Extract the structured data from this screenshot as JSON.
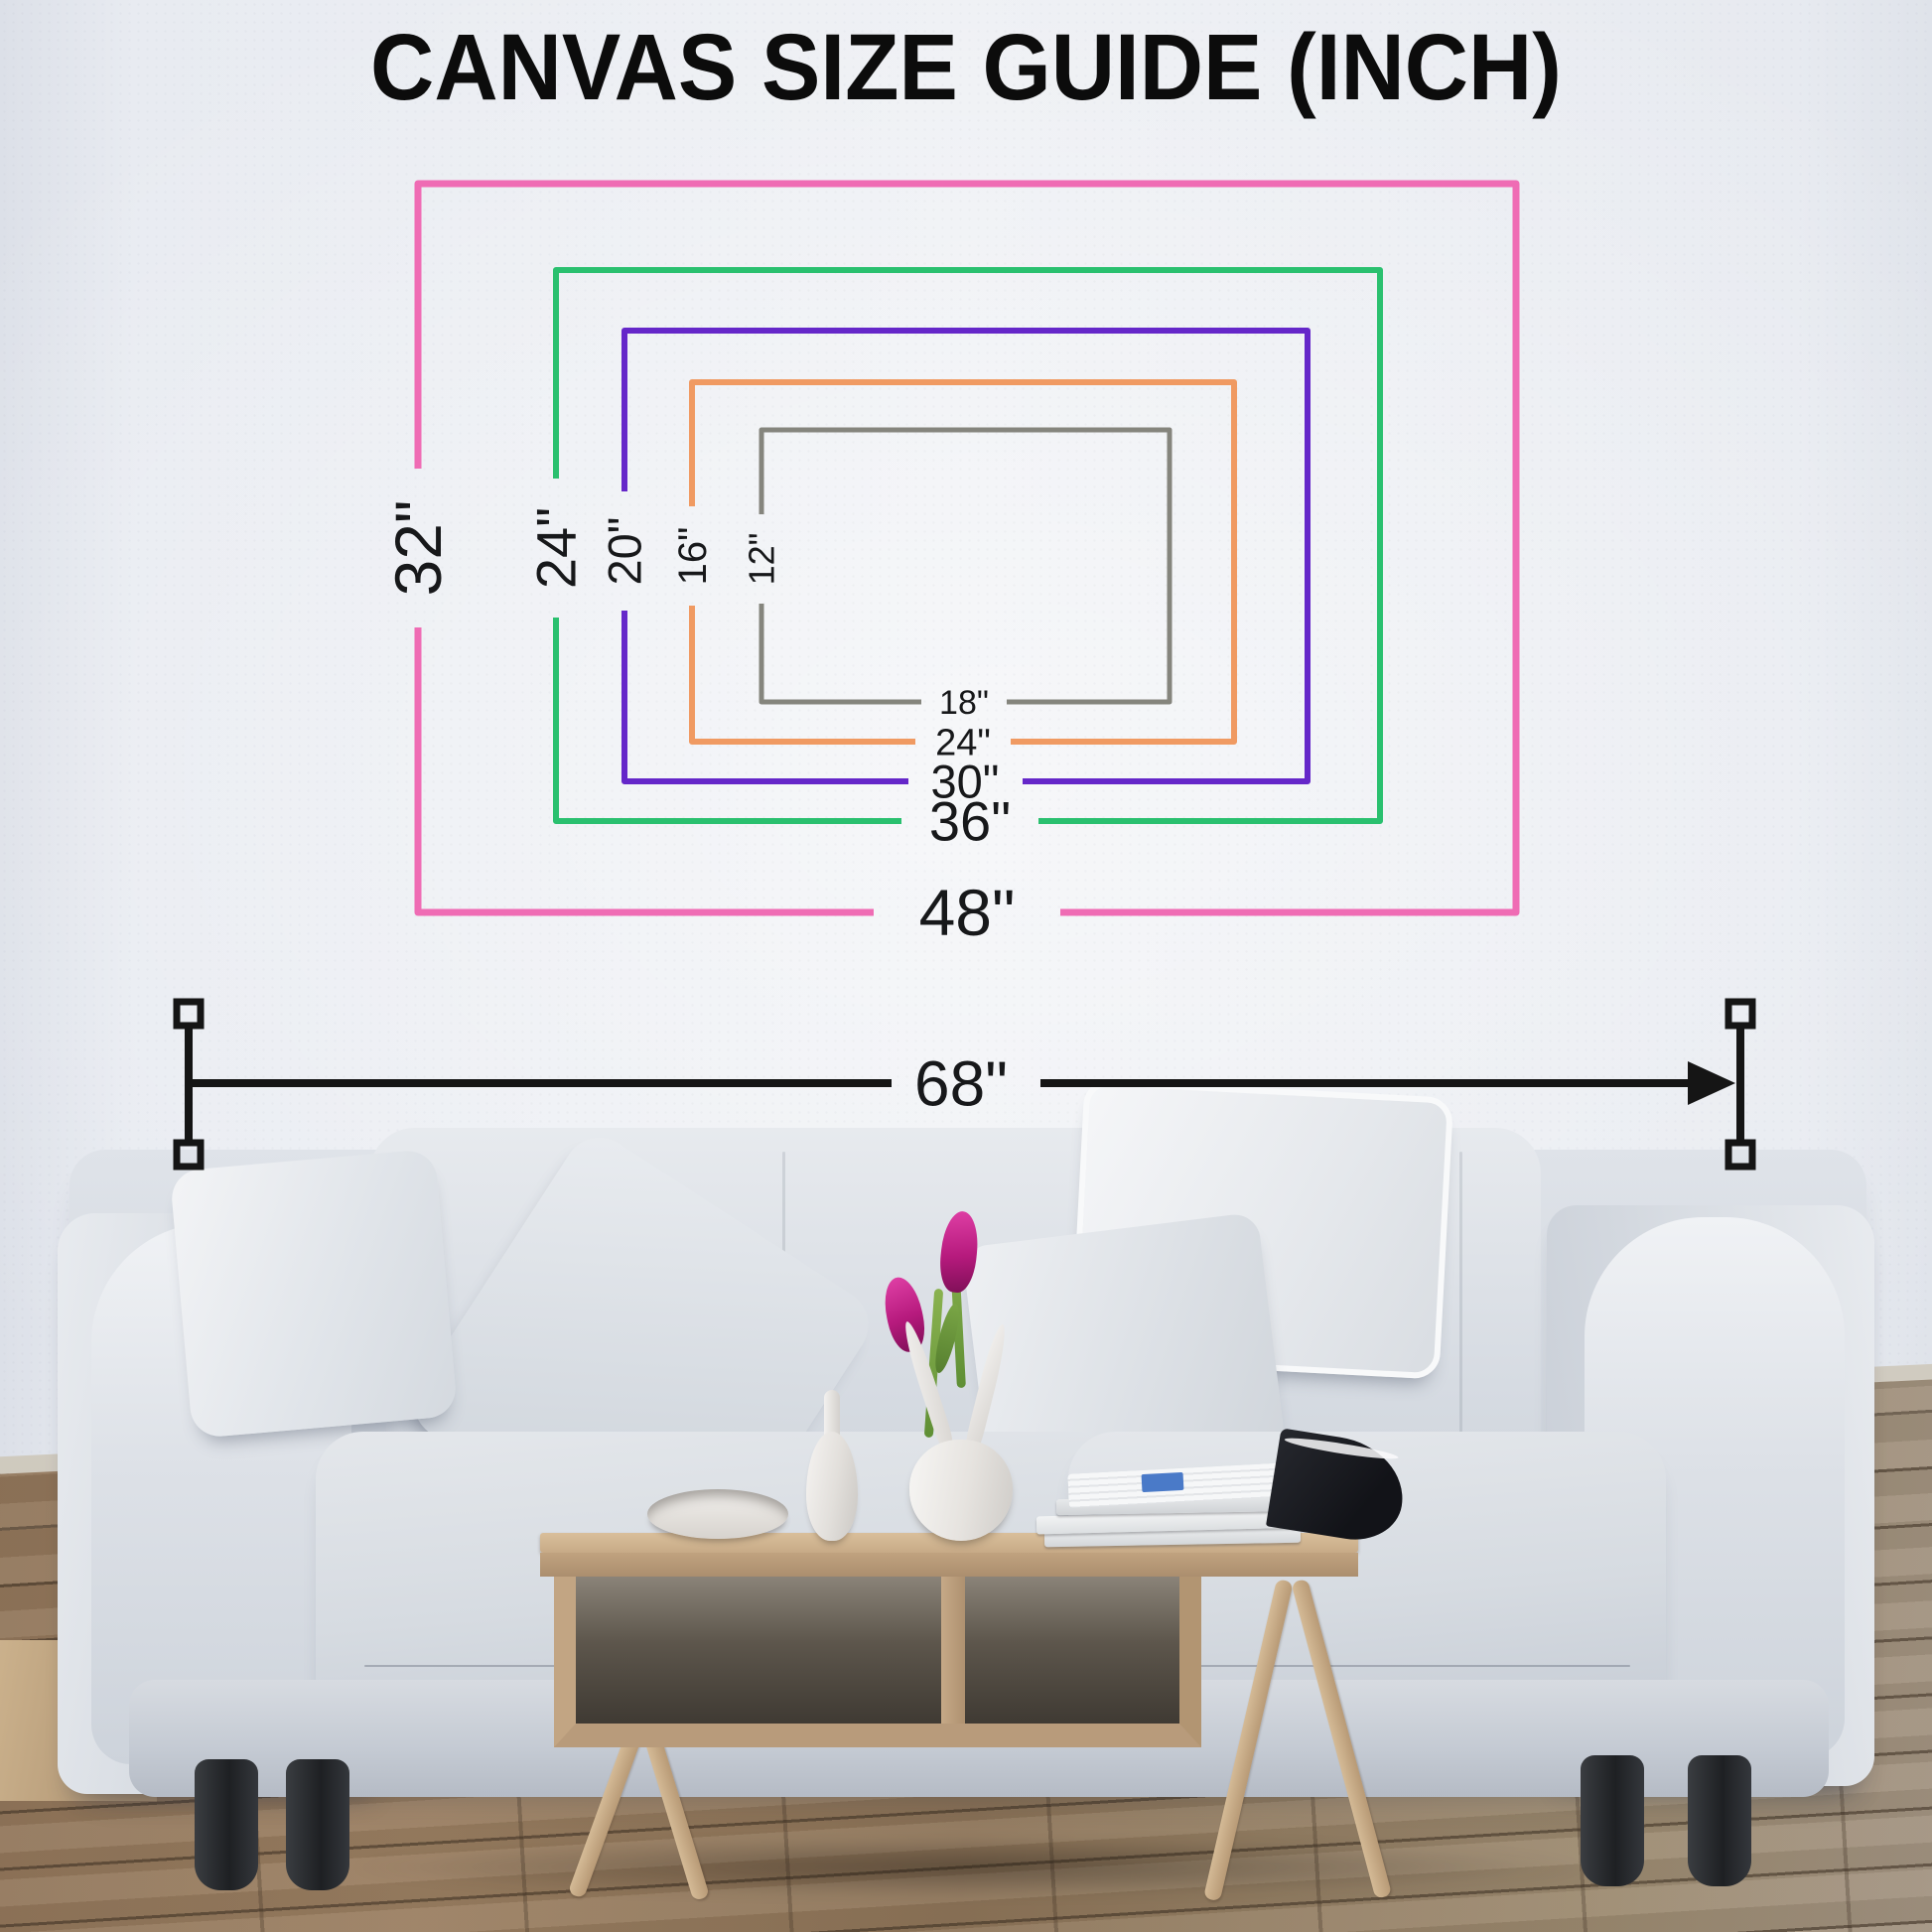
{
  "title": "CANVAS SIZE GUIDE (INCH)",
  "canvas_sizes": [
    {
      "size": "48x32",
      "width_in": 48,
      "height_in": 32,
      "width_label": "48\"",
      "height_label": "32\"",
      "color": "#ef6cb4"
    },
    {
      "size": "36x24",
      "width_in": 36,
      "height_in": 24,
      "width_label": "36\"",
      "height_label": "24\"",
      "color": "#2ac06f"
    },
    {
      "size": "30x20",
      "width_in": 30,
      "height_in": 20,
      "width_label": "30\"",
      "height_label": "20\"",
      "color": "#6527c9"
    },
    {
      "size": "24x16",
      "width_in": 24,
      "height_in": 16,
      "width_label": "24\"",
      "height_label": "16\"",
      "color": "#f09a62"
    },
    {
      "size": "18x12",
      "width_in": 18,
      "height_in": 12,
      "width_label": "18\"",
      "height_label": "12\"",
      "color": "#85857d"
    }
  ],
  "sofa_measurement": {
    "label": "68\"",
    "color": "#151515"
  }
}
